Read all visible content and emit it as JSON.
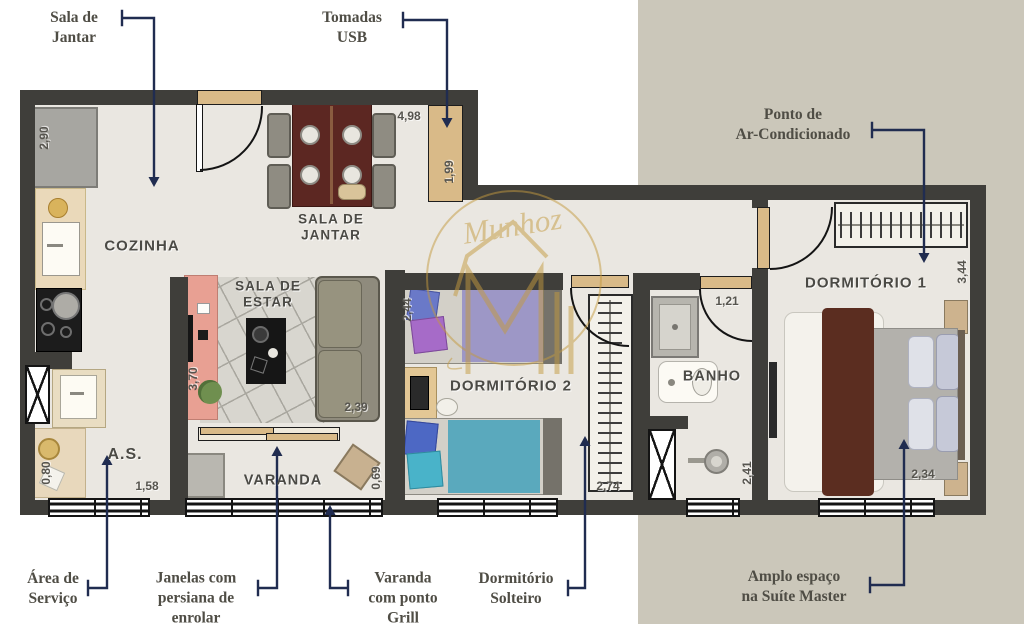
{
  "rooms": {
    "cozinha": {
      "label": "COZINHA"
    },
    "sala_jantar": {
      "label": "SALA DE\nJANTAR"
    },
    "sala_estar": {
      "label": "SALA DE\nESTAR"
    },
    "area_servico": {
      "label": "A.S."
    },
    "varanda": {
      "label": "VARANDA"
    },
    "dormitorio2": {
      "label": "DORMITÓRIO 2"
    },
    "banho": {
      "label": "BANHO"
    },
    "dormitorio1": {
      "label": "DORMITÓRIO 1"
    }
  },
  "measurements": {
    "fridge_side": "2,90",
    "social_width": "4,98",
    "sideboard": "1,99",
    "estar_depth": "3,70",
    "estar_width": "2,39",
    "as_depth": "0,80",
    "as_width": "1,58",
    "varanda_depth": "0,69",
    "dorm2_depth": "2,44",
    "closet_depth": "2,74",
    "banho_door": "1,21",
    "banho_depth": "2,41",
    "dorm1_depth": "3,44",
    "dorm1_width": "2,34"
  },
  "callouts": {
    "sala_jantar": "Sala de\nJantar",
    "tomadas_usb": "Tomadas\nUSB",
    "ar_condicionado": "Ponto de\nAr-Condicionado",
    "area_servico": "Área de\nServiço",
    "janelas": "Janelas com\npersiana de\nenrolar",
    "varanda_grill": "Varanda\ncom ponto\nGrill",
    "dorm_solteiro": "Dormitório\nSolteiro",
    "suite_master": "Amplo espaço\nna Suíte Master"
  },
  "watermark": {
    "script_text": "Munhoz"
  },
  "colors": {
    "wall": "#3f3e3a",
    "floor": "#eae7e1",
    "annotation_navy": "#202c50",
    "background_right": "#cbc7ba",
    "watermark_gold": "#c49a3f",
    "door_tan": "#d9ba88"
  }
}
